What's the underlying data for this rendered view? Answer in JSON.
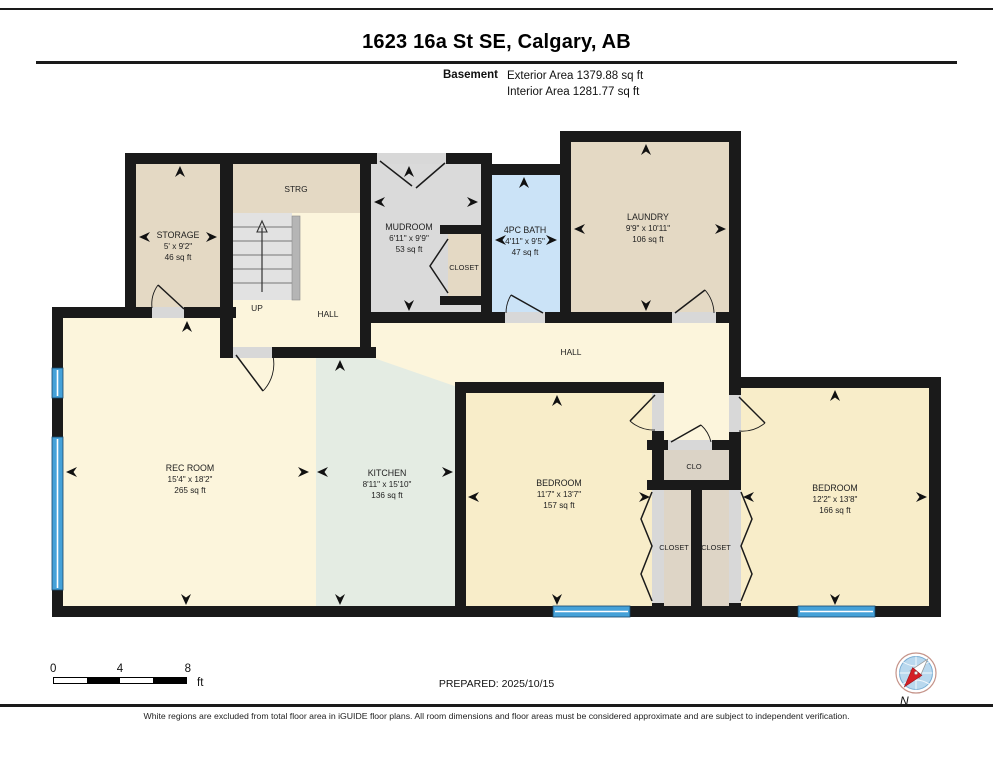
{
  "header": {
    "title": "1623 16a St SE, Calgary, AB",
    "floor_label": "Basement",
    "exterior_area": "Exterior Area 1379.88 sq ft",
    "interior_area": "Interior Area 1281.77 sq ft"
  },
  "rooms": [
    {
      "name": "STORAGE",
      "dims": "5' x 9'2\"",
      "area": "46 sq ft"
    },
    {
      "name": "STRG"
    },
    {
      "name": "MUDROOM",
      "dims": "6'11\" x 9'9\"",
      "area": "53 sq ft"
    },
    {
      "name": "CLOSET"
    },
    {
      "name": "4PC BATH",
      "dims": "4'11\" x 9'5\"",
      "area": "47 sq ft"
    },
    {
      "name": "LAUNDRY",
      "dims": "9'9\" x 10'11\"",
      "area": "106 sq ft"
    },
    {
      "name": "UP"
    },
    {
      "name": "HALL"
    },
    {
      "name": "HALL"
    },
    {
      "name": "REC ROOM",
      "dims": "15'4\" x 18'2\"",
      "area": "265 sq ft"
    },
    {
      "name": "KITCHEN",
      "dims": "8'11\" x 15'10\"",
      "area": "136 sq ft"
    },
    {
      "name": "BEDROOM",
      "dims": "11'7\" x 13'7\"",
      "area": "157 sq ft"
    },
    {
      "name": "CLO"
    },
    {
      "name": "CLOSET"
    },
    {
      "name": "CLOSET"
    },
    {
      "name": "BEDROOM",
      "dims": "12'2\" x 13'8\"",
      "area": "166 sq ft"
    }
  ],
  "footer": {
    "scale_ticks": [
      "0",
      "4",
      "8"
    ],
    "scale_unit": "ft",
    "prepared": "PREPARED: 2025/10/15",
    "compass_label": "N",
    "disclaimer": "White regions are excluded from total floor area in iGUIDE floor plans. All room dimensions and floor areas must be considered approximate and are subject to independent verification."
  },
  "colors": {
    "wall": "#1a1a1a",
    "floor_cream": "#fcf5dc",
    "bedroom_fill": "#f8edc9",
    "kitchen_fill": "#e4ece3",
    "beige_fill": "#e4d9c4",
    "mudroom_fill": "#dadada",
    "bath_fill": "#cbe3f7",
    "window_blue": "#45a1d8",
    "threshold_gray": "#d8d8d8"
  }
}
